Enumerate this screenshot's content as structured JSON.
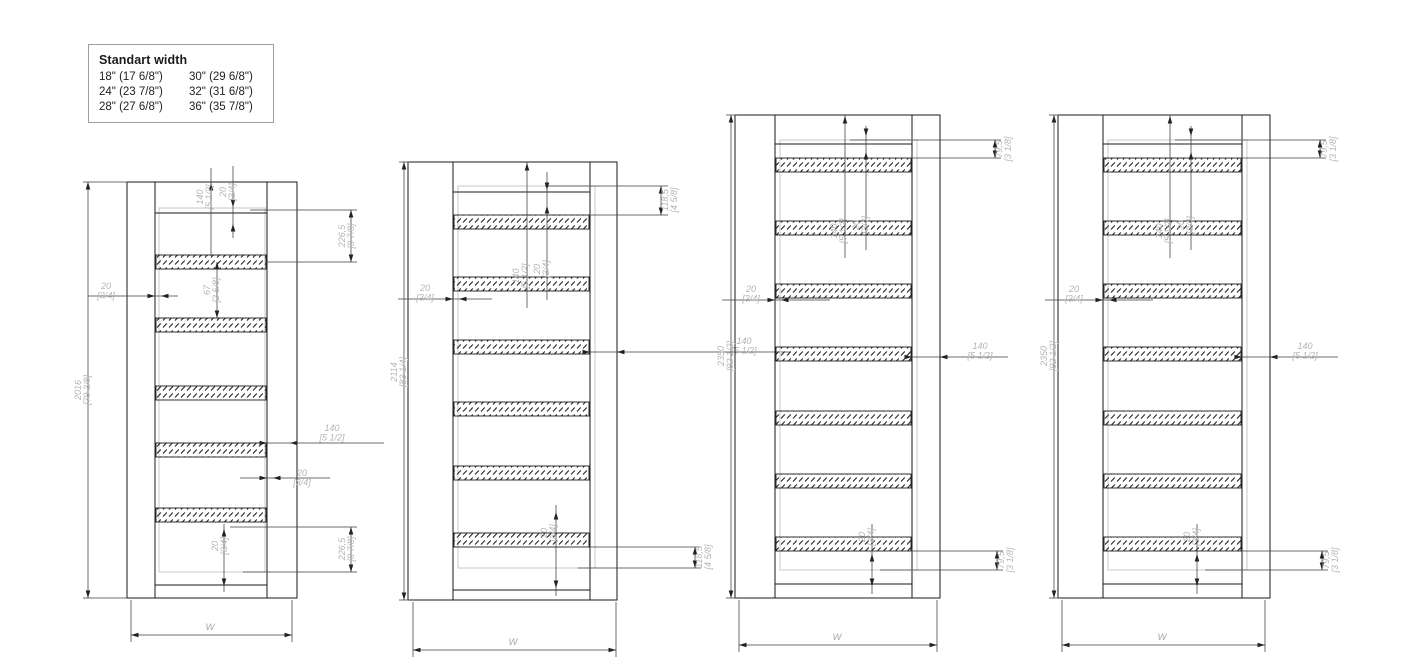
{
  "legend": {
    "title": "Standart width",
    "col1": [
      "18\" (17 6/8\")",
      "24\" (23 7/8\")",
      "28\" (27 6/8\")"
    ],
    "col2": [
      "30\" (29 6/8\")",
      "32\" (31 6/8\")",
      "36\" (35 7/8\")"
    ]
  },
  "doors": [
    {
      "height": {
        "mm": "2016",
        "inches": "[79 3/8]"
      },
      "width_label": "W",
      "louver_bands": 5,
      "dims": {
        "top-140": {
          "l1": "140",
          "l2": "[5 1/2]"
        },
        "top-20": {
          "l1": "20",
          "l2": "[3/4]"
        },
        "right-top": {
          "l1": "226,5",
          "l2": "[8 7/8]"
        },
        "left-20": {
          "l1": "20",
          "l2": "[3/4]"
        },
        "center-67": {
          "l1": "67",
          "l2": "[2 5/8]"
        },
        "right-140": {
          "l1": "140",
          "l2": "[5 1/2]"
        },
        "right-20": {
          "l1": "20",
          "l2": "[3/4]"
        },
        "bottom-20": {
          "l1": "20",
          "l2": "[3/4]"
        },
        "bottom-right": {
          "l1": "226,5",
          "l2": "[8 7/8]"
        }
      }
    },
    {
      "height": {
        "mm": "2114",
        "inches": "[83 1/4]"
      },
      "width_label": "W",
      "louver_bands": 6,
      "dims": {
        "top-right": {
          "l1": "118,5",
          "l2": "[4 5/8]"
        },
        "mid-140": {
          "l1": "140",
          "l2": "[5 1/2]"
        },
        "mid-20": {
          "l1": "20",
          "l2": "[3/4]"
        },
        "left-20": {
          "l1": "20",
          "l2": "[3/4]"
        },
        "right-140": {
          "l1": "140",
          "l2": "[5 1/2]"
        },
        "bottom-20": {
          "l1": "20",
          "l2": "[3/4]"
        },
        "bottom-right": {
          "l1": "118,5",
          "l2": "[4 5/8]"
        }
      }
    },
    {
      "height": {
        "mm": "2350",
        "inches": "[92 1/2]"
      },
      "width_label": "W",
      "louver_bands": 7,
      "dims": {
        "top-right": {
          "l1": "79,5",
          "l2": "[3 1/8]"
        },
        "mid-140": {
          "l1": "140",
          "l2": "[5 1/2]"
        },
        "mid-20": {
          "l1": "20",
          "l2": "[3/4]"
        },
        "left-20": {
          "l1": "20",
          "l2": "[3/4]"
        },
        "right-140": {
          "l1": "140",
          "l2": "[5 1/2]"
        },
        "bottom-20": {
          "l1": "20",
          "l2": "[3/4]"
        },
        "bottom-right": {
          "l1": "79,5",
          "l2": "[3 1/8]"
        }
      }
    },
    {
      "height": {
        "mm": "2350",
        "inches": "[92 1/2]"
      },
      "width_label": "W",
      "louver_bands": 7,
      "dims": {
        "top-right": {
          "l1": "79,5",
          "l2": "[3 1/8]"
        },
        "mid-140": {
          "l1": "140",
          "l2": "[5 1/2]"
        },
        "mid-20": {
          "l1": "20",
          "l2": "[3/4]"
        },
        "left-20": {
          "l1": "20",
          "l2": "[3/4]"
        },
        "right-140": {
          "l1": "140",
          "l2": "[5 1/2]"
        },
        "bottom-20": {
          "l1": "20",
          "l2": "[3/4]"
        },
        "bottom-right": {
          "l1": "79,5",
          "l2": "[3 1/8]"
        }
      }
    }
  ]
}
